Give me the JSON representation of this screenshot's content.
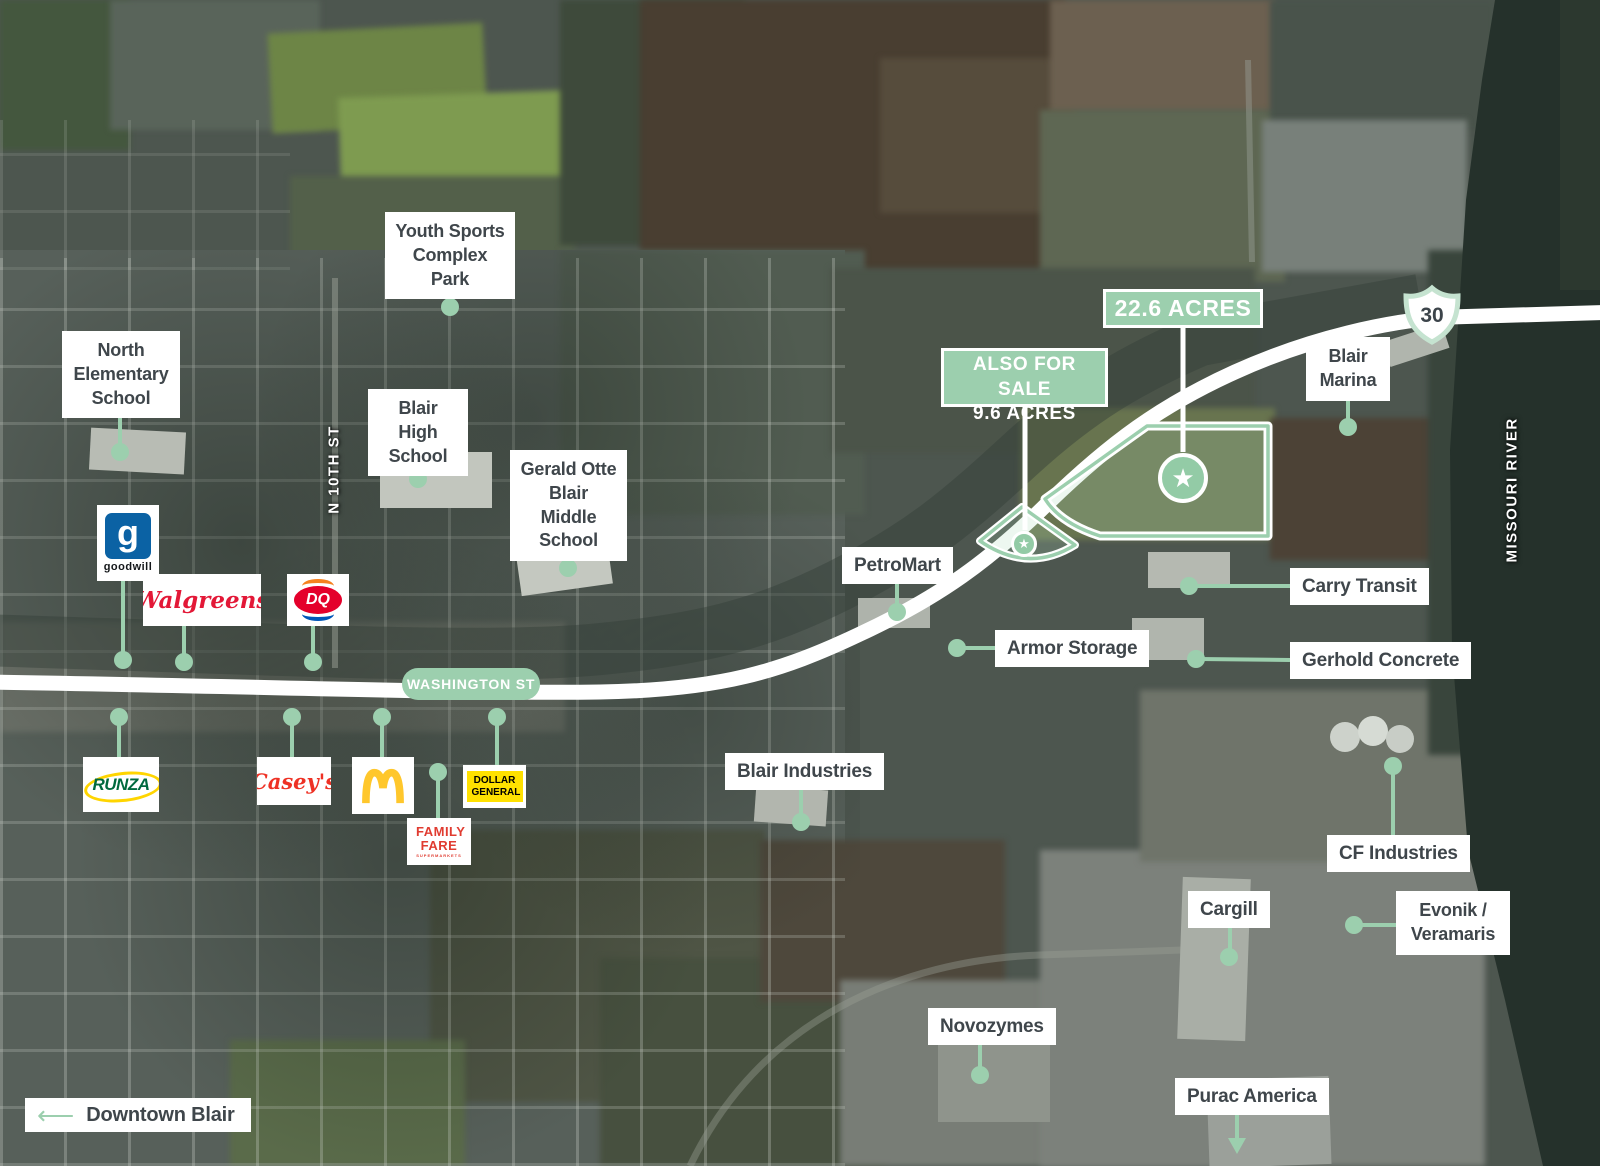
{
  "banners": {
    "primary": "22.6 ACRES",
    "secondary_line1": "ALSO FOR SALE",
    "secondary_line2": "9.6 ACRES"
  },
  "roads": {
    "washington_st": "WASHINGTON ST",
    "highway_number": "30",
    "n_10th_st": "N 10TH ST",
    "missouri_river": "MISSOURI RIVER"
  },
  "places": {
    "youth_sports": "Youth Sports Complex Park",
    "north_elementary": "North Elementary School",
    "blair_high": "Blair High School",
    "gerald_otte": "Gerald Otte Blair Middle School",
    "blair_marina": "Blair Marina",
    "petromart": "PetroMart",
    "carry_transit": "Carry Transit",
    "armor_storage": "Armor Storage",
    "gerhold_concrete": "Gerhold Concrete",
    "blair_industries": "Blair Industries",
    "cf_industries": "CF Industries",
    "cargill": "Cargill",
    "evonik": "Evonik / Veramaris",
    "novozymes": "Novozymes",
    "purac": "Purac America",
    "downtown": "Downtown Blair"
  },
  "logos": {
    "goodwill_glyph": "g",
    "goodwill": "goodwill",
    "walgreens": "Walgreens",
    "dq": "DQ",
    "runza": "RUNZA",
    "caseys": "Casey's",
    "mcdonalds": "McDonald's",
    "dollar_general": "DOLLAR GENERAL",
    "family_fare": "FAMILY FARE",
    "family_fare_sub": "SUPERMARKETS"
  },
  "icons": {
    "star": "★",
    "arrow_left": "⟵"
  },
  "colors": {
    "accent_green": "#9ccfae",
    "label_text": "#3f464b",
    "road_white": "#ffffff",
    "river_dark": "#25312b"
  }
}
